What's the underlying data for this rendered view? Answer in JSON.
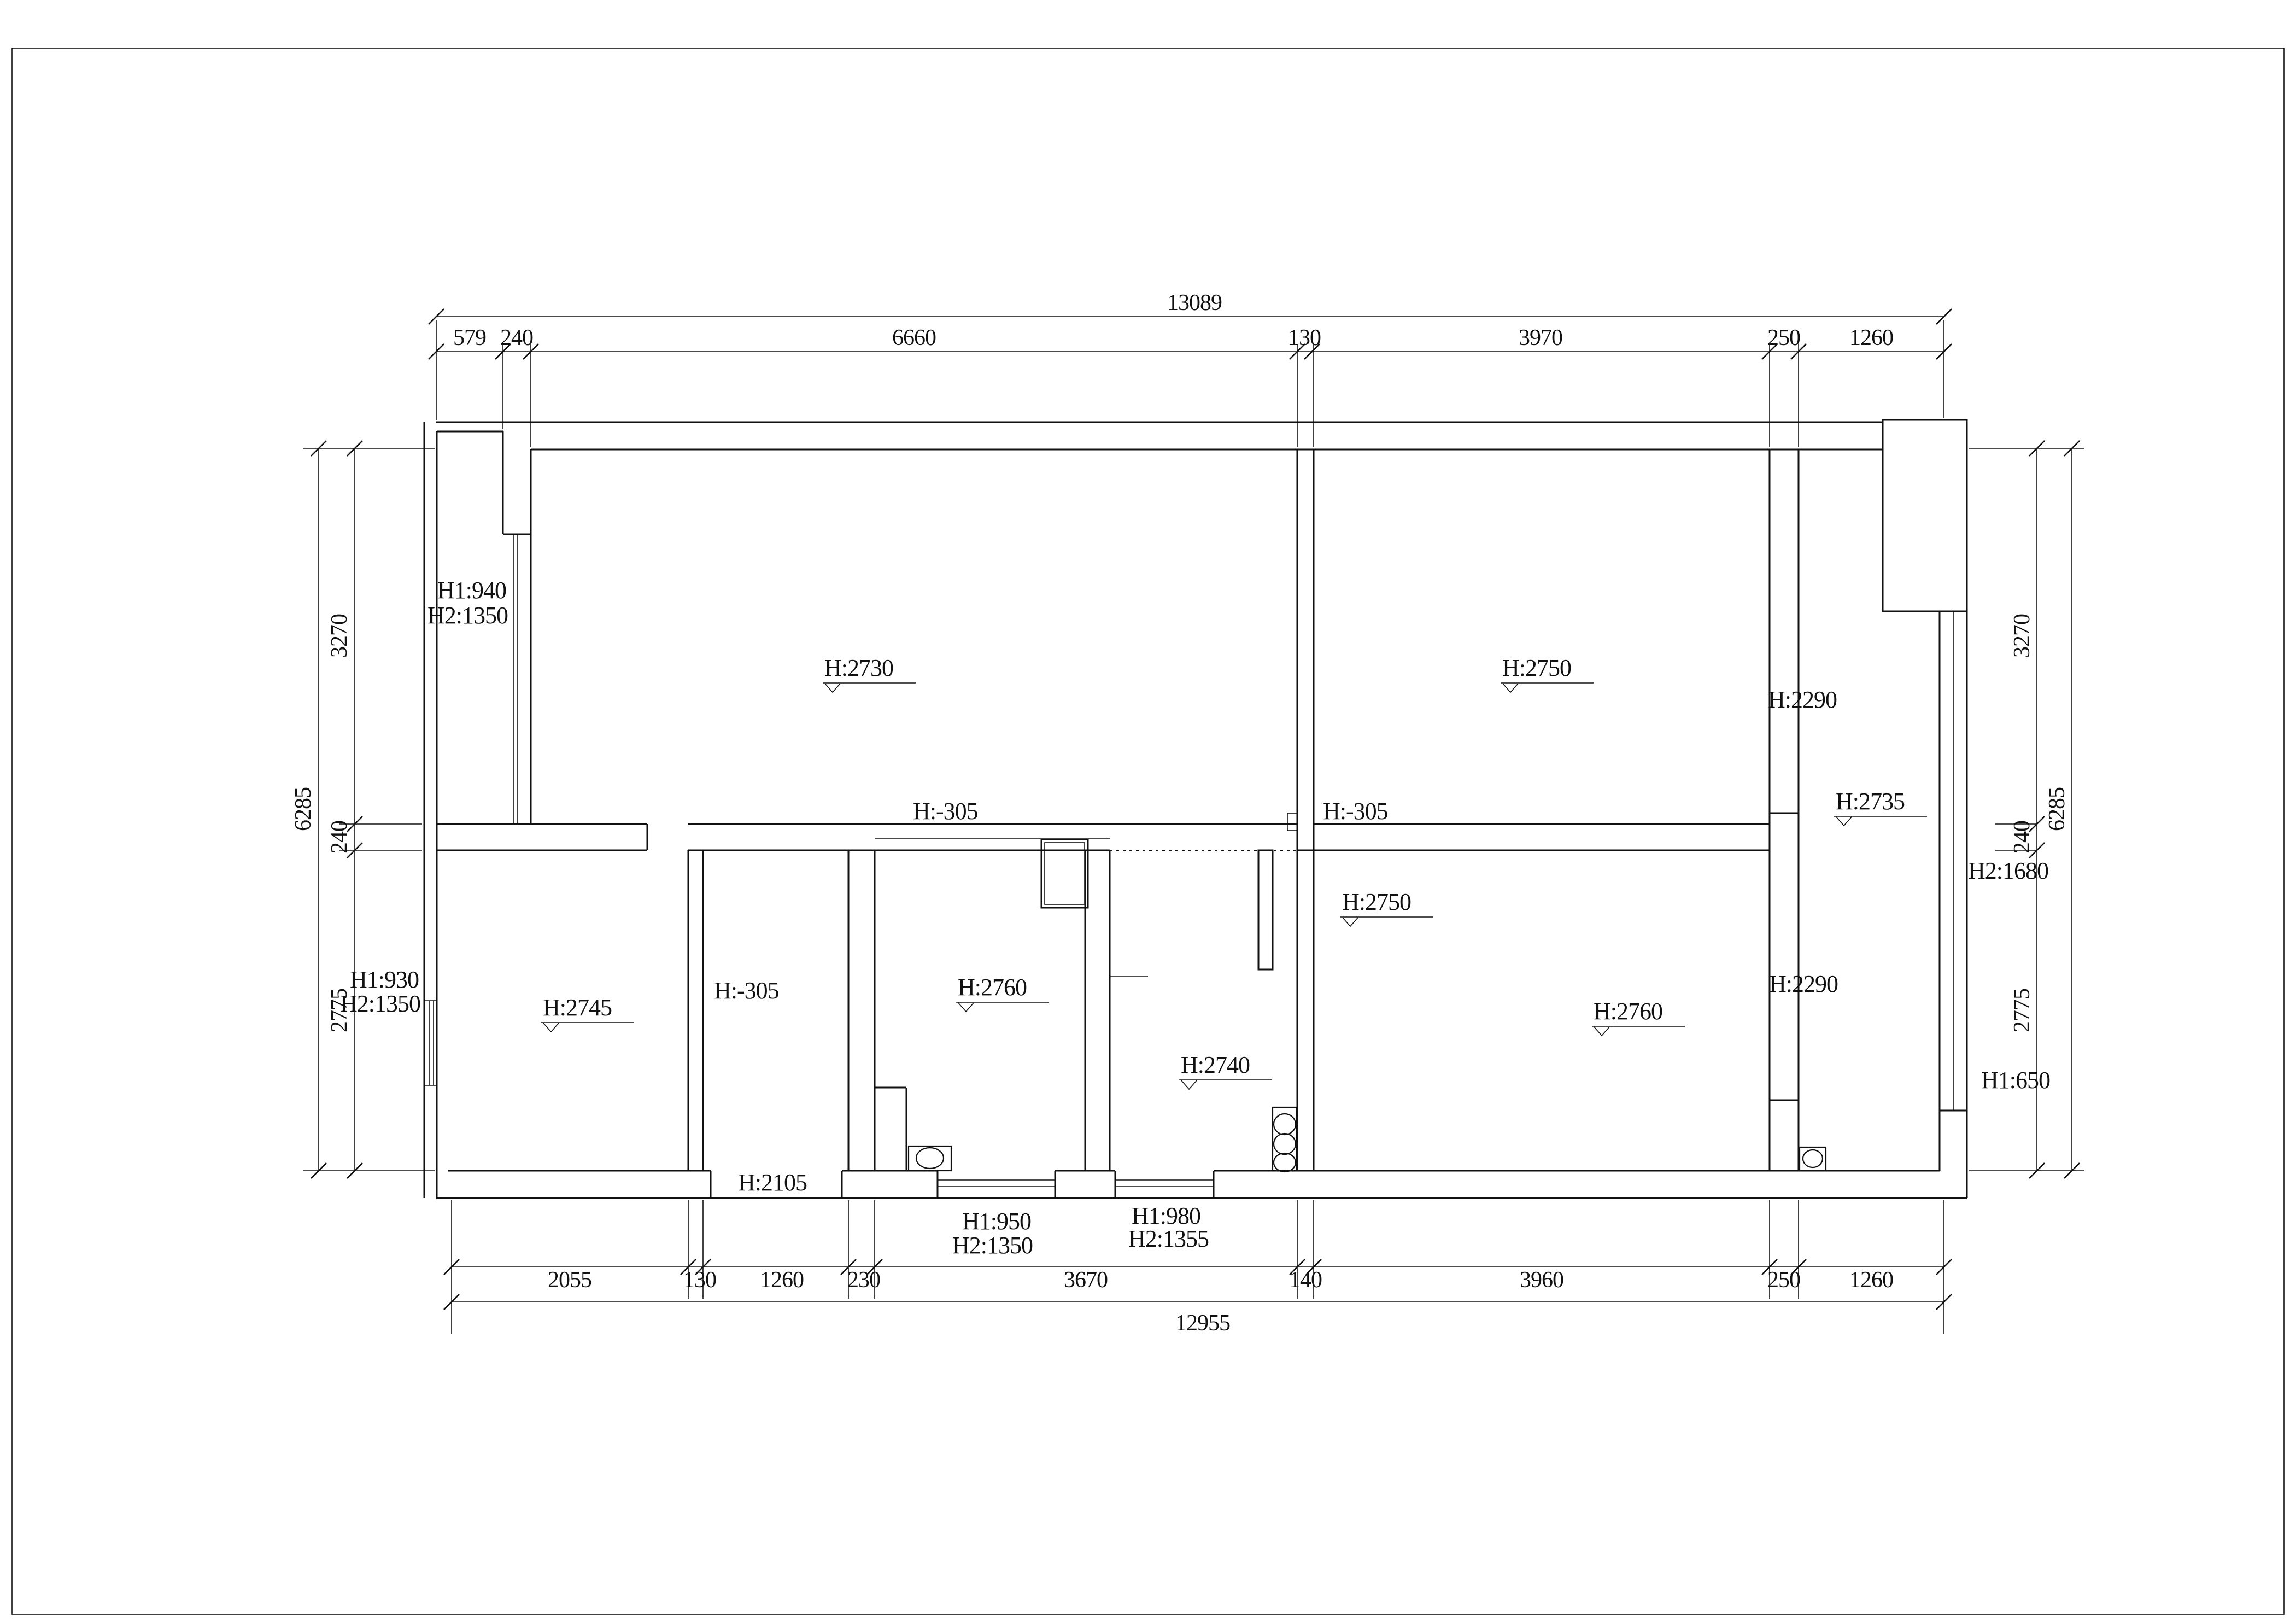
{
  "levels": {
    "upper_left_room": "H:2730",
    "upper_right_room": "H:2750",
    "corridor_top": "H:2290",
    "corridor_mid": "H:2735",
    "drop_left": "H:-305",
    "drop_right": "H:-305",
    "center_room": "H:2750",
    "left_room": "H:2745",
    "entry_drop": "H:-305",
    "kitchen": "H:2760",
    "hall": "H:2740",
    "lower_right_room": "H:2760",
    "corridor_bottom": "H:2290",
    "entry_door": "H:2105"
  },
  "window_notes": {
    "bay": [
      "H1:940",
      "H2:1350"
    ],
    "left": [
      "H1:930",
      "H2:1350"
    ],
    "right_upper": "H2:1680",
    "right_lower": "H1:650",
    "bottom_a": [
      "H1:950",
      "H2:1350"
    ],
    "bottom_b": [
      "H1:980",
      "H2:1355"
    ]
  },
  "dims": {
    "top_total": "13089",
    "top": [
      "579",
      "240",
      "6660",
      "130",
      "3970",
      "250",
      "1260"
    ],
    "left_total": "6285",
    "left": [
      "3270",
      "240",
      "2775"
    ],
    "right_total": "6285",
    "right": [
      "3270",
      "240",
      "2775"
    ],
    "bottom": [
      "2055",
      "130",
      "1260",
      "230",
      "3670",
      "140",
      "3960",
      "250",
      "1260"
    ],
    "bottom_total": "12955"
  }
}
